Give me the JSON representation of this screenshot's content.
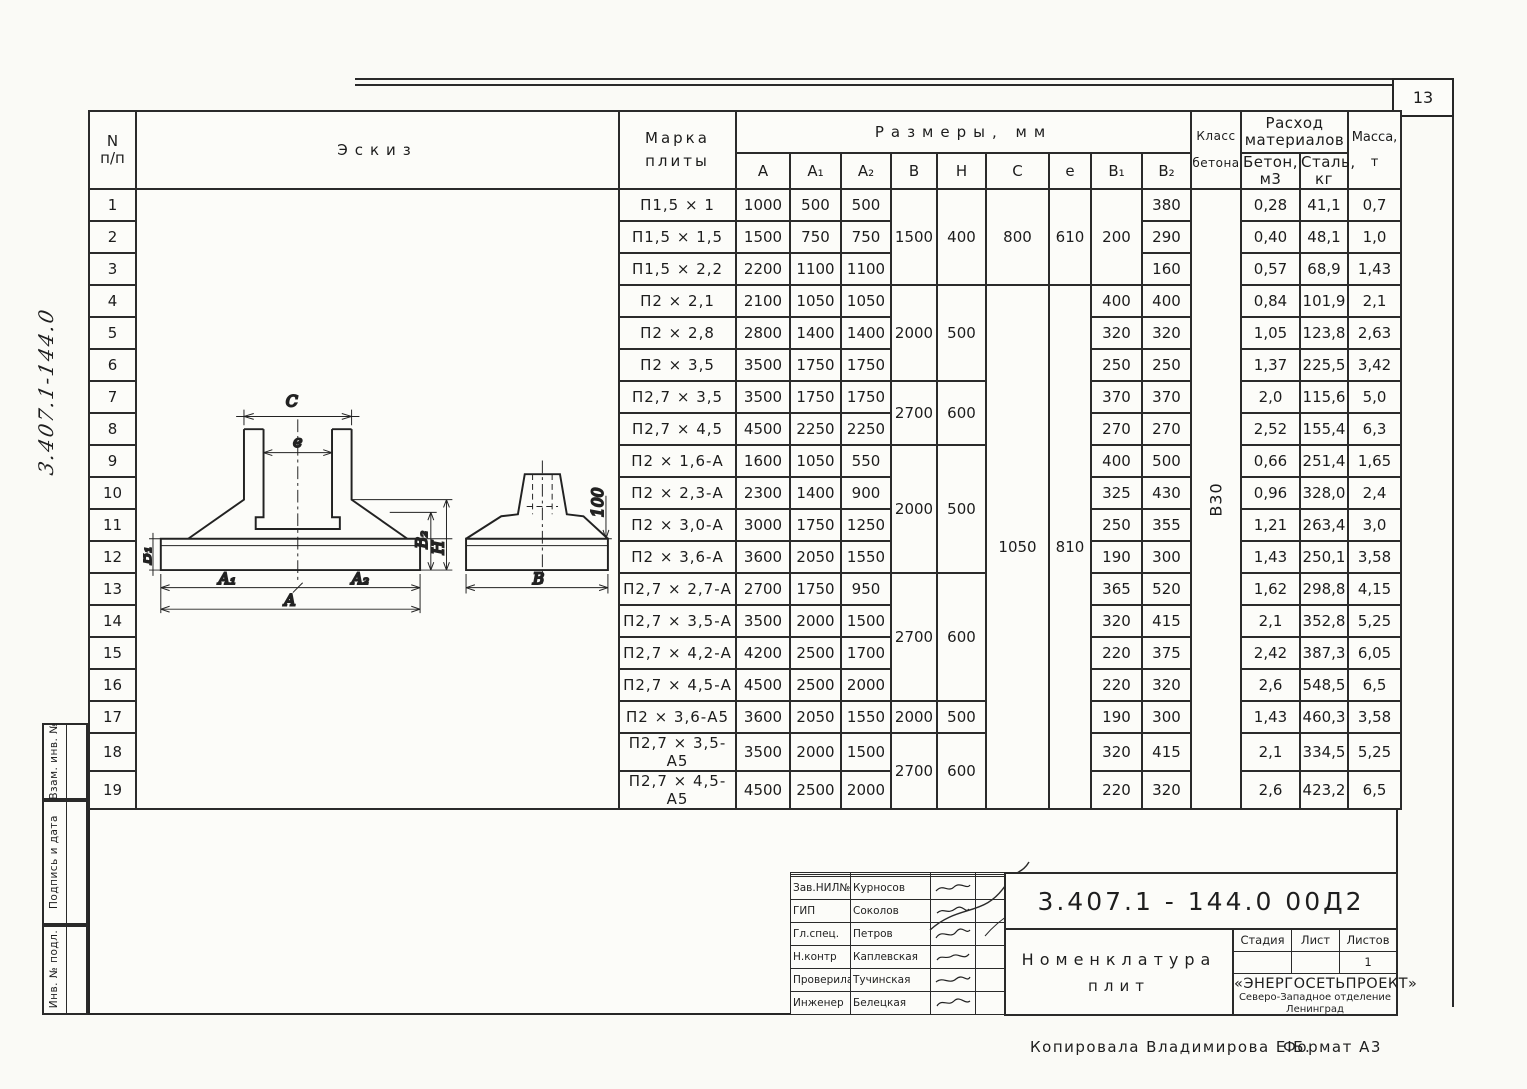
{
  "page": {
    "number": "13",
    "margin_code": "3.407.1-144.0",
    "copy_note": "Копировала  Владимирова Е.Б.",
    "format_note": "Формат А3"
  },
  "sidebar": {
    "labels": [
      "Взам. инв. №",
      "Подпись и дата",
      "Инв. № подл."
    ]
  },
  "table": {
    "headers": {
      "num": "N",
      "num2": "п/п",
      "sketch": "Эскиз",
      "mark1": "Марка",
      "mark2": "плиты",
      "sizes": "Размеры,  мм",
      "a": "А",
      "a1": "А₁",
      "a2": "А₂",
      "b": "В",
      "h": "Н",
      "c": "С",
      "e": "е",
      "b1": "В₁",
      "b2": "В₂",
      "class1": "Класс",
      "class2": "бетона",
      "materials1": "Расход",
      "materials2": "материалов",
      "concrete1": "Бетон,",
      "concrete2": "м3",
      "steel1": "Сталь,",
      "steel2": "кг",
      "mass1": "Масса,",
      "mass2": "т"
    },
    "rows": [
      {
        "n": "1",
        "mark": "П1,5 × 1",
        "a": "1000",
        "a1": "500",
        "a2": "500",
        "b": "1500",
        "h": "400",
        "c": "800",
        "e": "610",
        "b1": "200",
        "b2": "380",
        "cls": "В30",
        "concrete": "0,28",
        "steel": "41,1",
        "mass": "0,7"
      },
      {
        "n": "2",
        "mark": "П1,5 × 1,5",
        "a": "1500",
        "a1": "750",
        "a2": "750",
        "b2": "290",
        "concrete": "0,40",
        "steel": "48,1",
        "mass": "1,0"
      },
      {
        "n": "3",
        "mark": "П1,5 × 2,2",
        "a": "2200",
        "a1": "1100",
        "a2": "1100",
        "b2": "160",
        "concrete": "0,57",
        "steel": "68,9",
        "mass": "1,43"
      },
      {
        "n": "4",
        "mark": "П2 × 2,1",
        "a": "2100",
        "a1": "1050",
        "a2": "1050",
        "b": "2000",
        "h": "500",
        "c": "1050",
        "e": "810",
        "b1": "400",
        "b2": "400",
        "concrete": "0,84",
        "steel": "101,9",
        "mass": "2,1"
      },
      {
        "n": "5",
        "mark": "П2 × 2,8",
        "a": "2800",
        "a1": "1400",
        "a2": "1400",
        "b1": "320",
        "b2": "320",
        "concrete": "1,05",
        "steel": "123,8",
        "mass": "2,63"
      },
      {
        "n": "6",
        "mark": "П2 × 3,5",
        "a": "3500",
        "a1": "1750",
        "a2": "1750",
        "b1": "250",
        "b2": "250",
        "concrete": "1,37",
        "steel": "225,5",
        "mass": "3,42"
      },
      {
        "n": "7",
        "mark": "П2,7 × 3,5",
        "a": "3500",
        "a1": "1750",
        "a2": "1750",
        "b": "2700",
        "h": "600",
        "b1": "370",
        "b2": "370",
        "concrete": "2,0",
        "steel": "115,6",
        "mass": "5,0"
      },
      {
        "n": "8",
        "mark": "П2,7 × 4,5",
        "a": "4500",
        "a1": "2250",
        "a2": "2250",
        "b1": "270",
        "b2": "270",
        "concrete": "2,52",
        "steel": "155,4",
        "mass": "6,3"
      },
      {
        "n": "9",
        "mark": "П2 × 1,6-А",
        "a": "1600",
        "a1": "1050",
        "a2": "550",
        "b": "2000",
        "h": "500",
        "b1": "400",
        "b2": "500",
        "concrete": "0,66",
        "steel": "251,4",
        "mass": "1,65"
      },
      {
        "n": "10",
        "mark": "П2 × 2,3-А",
        "a": "2300",
        "a1": "1400",
        "a2": "900",
        "b1": "325",
        "b2": "430",
        "concrete": "0,96",
        "steel": "328,0",
        "mass": "2,4"
      },
      {
        "n": "11",
        "mark": "П2 × 3,0-А",
        "a": "3000",
        "a1": "1750",
        "a2": "1250",
        "b1": "250",
        "b2": "355",
        "concrete": "1,21",
        "steel": "263,4",
        "mass": "3,0"
      },
      {
        "n": "12",
        "mark": "П2 × 3,6-А",
        "a": "3600",
        "a1": "2050",
        "a2": "1550",
        "b1": "190",
        "b2": "300",
        "concrete": "1,43",
        "steel": "250,1",
        "mass": "3,58"
      },
      {
        "n": "13",
        "mark": "П2,7 × 2,7-А",
        "a": "2700",
        "a1": "1750",
        "a2": "950",
        "b": "2700",
        "h": "600",
        "b1": "365",
        "b2": "520",
        "concrete": "1,62",
        "steel": "298,8",
        "mass": "4,15"
      },
      {
        "n": "14",
        "mark": "П2,7 × 3,5-А",
        "a": "3500",
        "a1": "2000",
        "a2": "1500",
        "b1": "320",
        "b2": "415",
        "concrete": "2,1",
        "steel": "352,8",
        "mass": "5,25"
      },
      {
        "n": "15",
        "mark": "П2,7 × 4,2-А",
        "a": "4200",
        "a1": "2500",
        "a2": "1700",
        "b1": "220",
        "b2": "375",
        "concrete": "2,42",
        "steel": "387,3",
        "mass": "6,05"
      },
      {
        "n": "16",
        "mark": "П2,7 × 4,5-А",
        "a": "4500",
        "a1": "2500",
        "a2": "2000",
        "b1": "220",
        "b2": "320",
        "concrete": "2,6",
        "steel": "548,5",
        "mass": "6,5"
      },
      {
        "n": "17",
        "mark": "П2 × 3,6-А5",
        "a": "3600",
        "a1": "2050",
        "a2": "1550",
        "b": "2000",
        "h": "500",
        "b1": "190",
        "b2": "300",
        "concrete": "1,43",
        "steel": "460,3",
        "mass": "3,58"
      },
      {
        "n": "18",
        "mark": "П2,7 × 3,5-А5",
        "a": "3500",
        "a1": "2000",
        "a2": "1500",
        "b": "2700",
        "h": "600",
        "b1": "320",
        "b2": "415",
        "concrete": "2,1",
        "steel": "334,5",
        "mass": "5,25"
      },
      {
        "n": "19",
        "mark": "П2,7 × 4,5-А5",
        "a": "4500",
        "a1": "2500",
        "a2": "2000",
        "b1": "220",
        "b2": "320",
        "concrete": "2,6",
        "steel": "423,2",
        "mass": "6,5"
      }
    ]
  },
  "sketch": {
    "c": "C",
    "e": "e",
    "b1": "B₁",
    "b2": "B₂",
    "h": "H",
    "a1": "A₁",
    "a2": "A₂",
    "a": "A",
    "b": "B",
    "dim100": "100"
  },
  "titleblock": {
    "doc_number": "3.407.1 - 144.0   00Д2",
    "title1": "Номенклатура",
    "title2": "плит",
    "stage_label": "Стадия",
    "sheet_label": "Лист",
    "sheets_label": "Листов",
    "sheets_value": "1",
    "org_name": "«ЭНЕРГОСЕТЬПРОЕКТ»",
    "org_branch": "Северо-Западное отделение",
    "org_city": "Ленинград",
    "signatures": [
      {
        "role": "Зав.НИЛ№2",
        "name": "Курносов"
      },
      {
        "role": "ГИП",
        "name": "Соколов"
      },
      {
        "role": "Гл.спец.",
        "name": "Петров"
      },
      {
        "role": "Н.контр",
        "name": "Каплевская"
      },
      {
        "role": "Проверила",
        "name": "Тучинская"
      },
      {
        "role": "Инженер",
        "name": "Белецкая"
      }
    ]
  }
}
